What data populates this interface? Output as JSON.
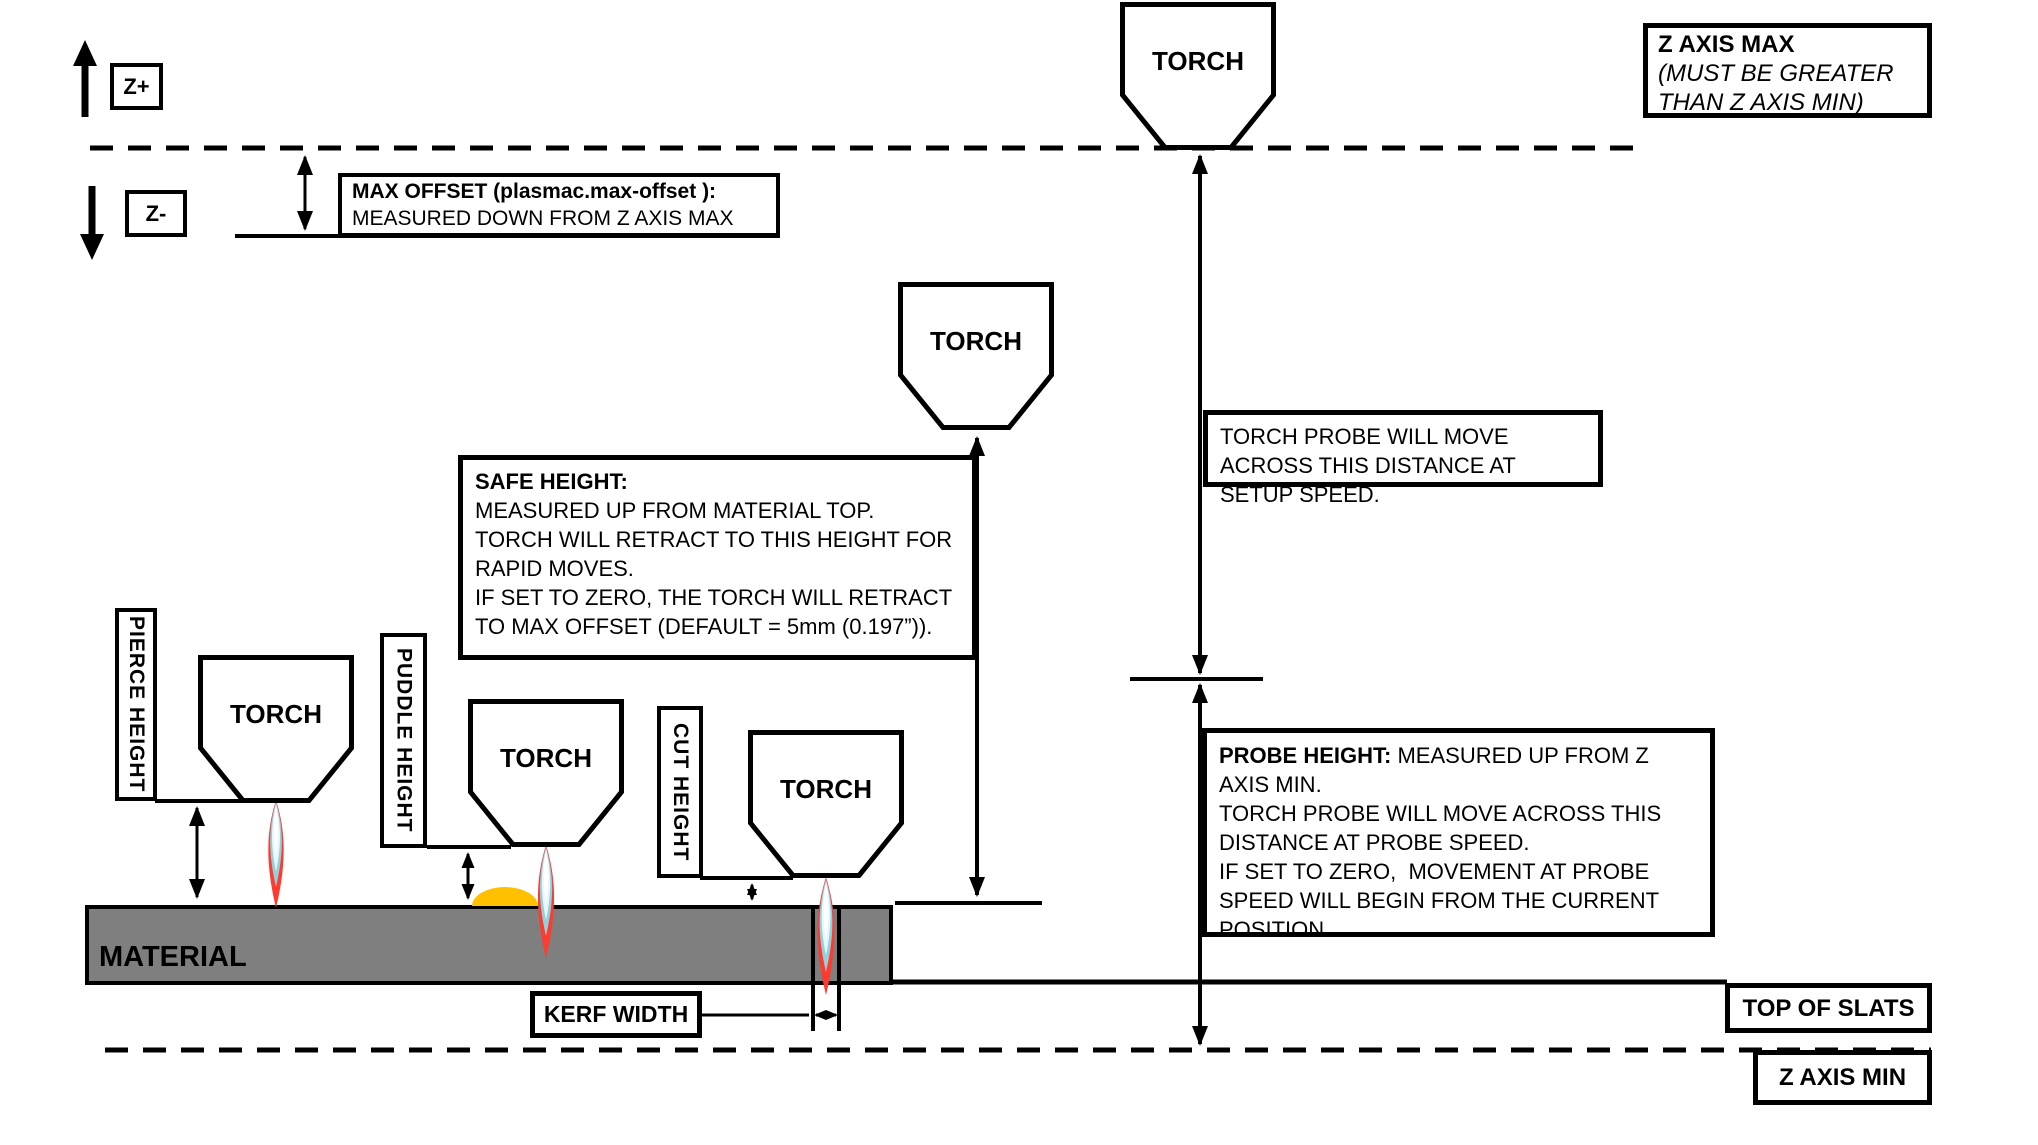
{
  "axis_indicators": {
    "up_label": "Z+",
    "down_label": "Z-"
  },
  "z_axis_max_box": {
    "title": "Z AXIS MAX",
    "subtitle": "(MUST BE GREATER\nTHAN Z AXIS MIN)"
  },
  "max_offset_box": {
    "title": "MAX OFFSET (plasmac.max-offset ):",
    "body": "MEASURED DOWN FROM Z AXIS MAX"
  },
  "safe_height_box": {
    "title": "SAFE HEIGHT:",
    "body": "MEASURED UP FROM MATERIAL TOP.\nTORCH WILL RETRACT TO THIS HEIGHT FOR RAPID MOVES.\nIF SET TO ZERO, THE TORCH WILL RETRACT TO MAX OFFSET (DEFAULT = 5mm (0.197”))."
  },
  "torch_probe_box": {
    "body": "TORCH PROBE WILL MOVE ACROSS THIS DISTANCE AT SETUP SPEED."
  },
  "probe_height_box": {
    "title": "PROBE HEIGHT:",
    "body": "MEASURED UP FROM Z AXIS MIN.\nTORCH PROBE WILL MOVE ACROSS THIS DISTANCE AT PROBE SPEED.\nIF SET TO ZERO,  MOVEMENT AT PROBE SPEED WILL BEGIN FROM THE CURRENT POSITION."
  },
  "height_labels": {
    "pierce": "PIERCE HEIGHT",
    "puddle": "PUDDLE HEIGHT",
    "cut": "CUT HEIGHT"
  },
  "torch_label": "TORCH",
  "material_label": "MATERIAL",
  "kerf_width_label": "KERF WIDTH",
  "top_of_slats_label": "TOP OF SLATS",
  "z_axis_min_label": "Z AXIS MIN",
  "colors": {
    "material_gray": "#7F7F7F",
    "puddle_orange": "#FFC000",
    "flame_red": "#FF3B30",
    "flame_teal": "#8FD2DE",
    "flame_core": "#E7F6FA",
    "line_black": "#000000"
  }
}
